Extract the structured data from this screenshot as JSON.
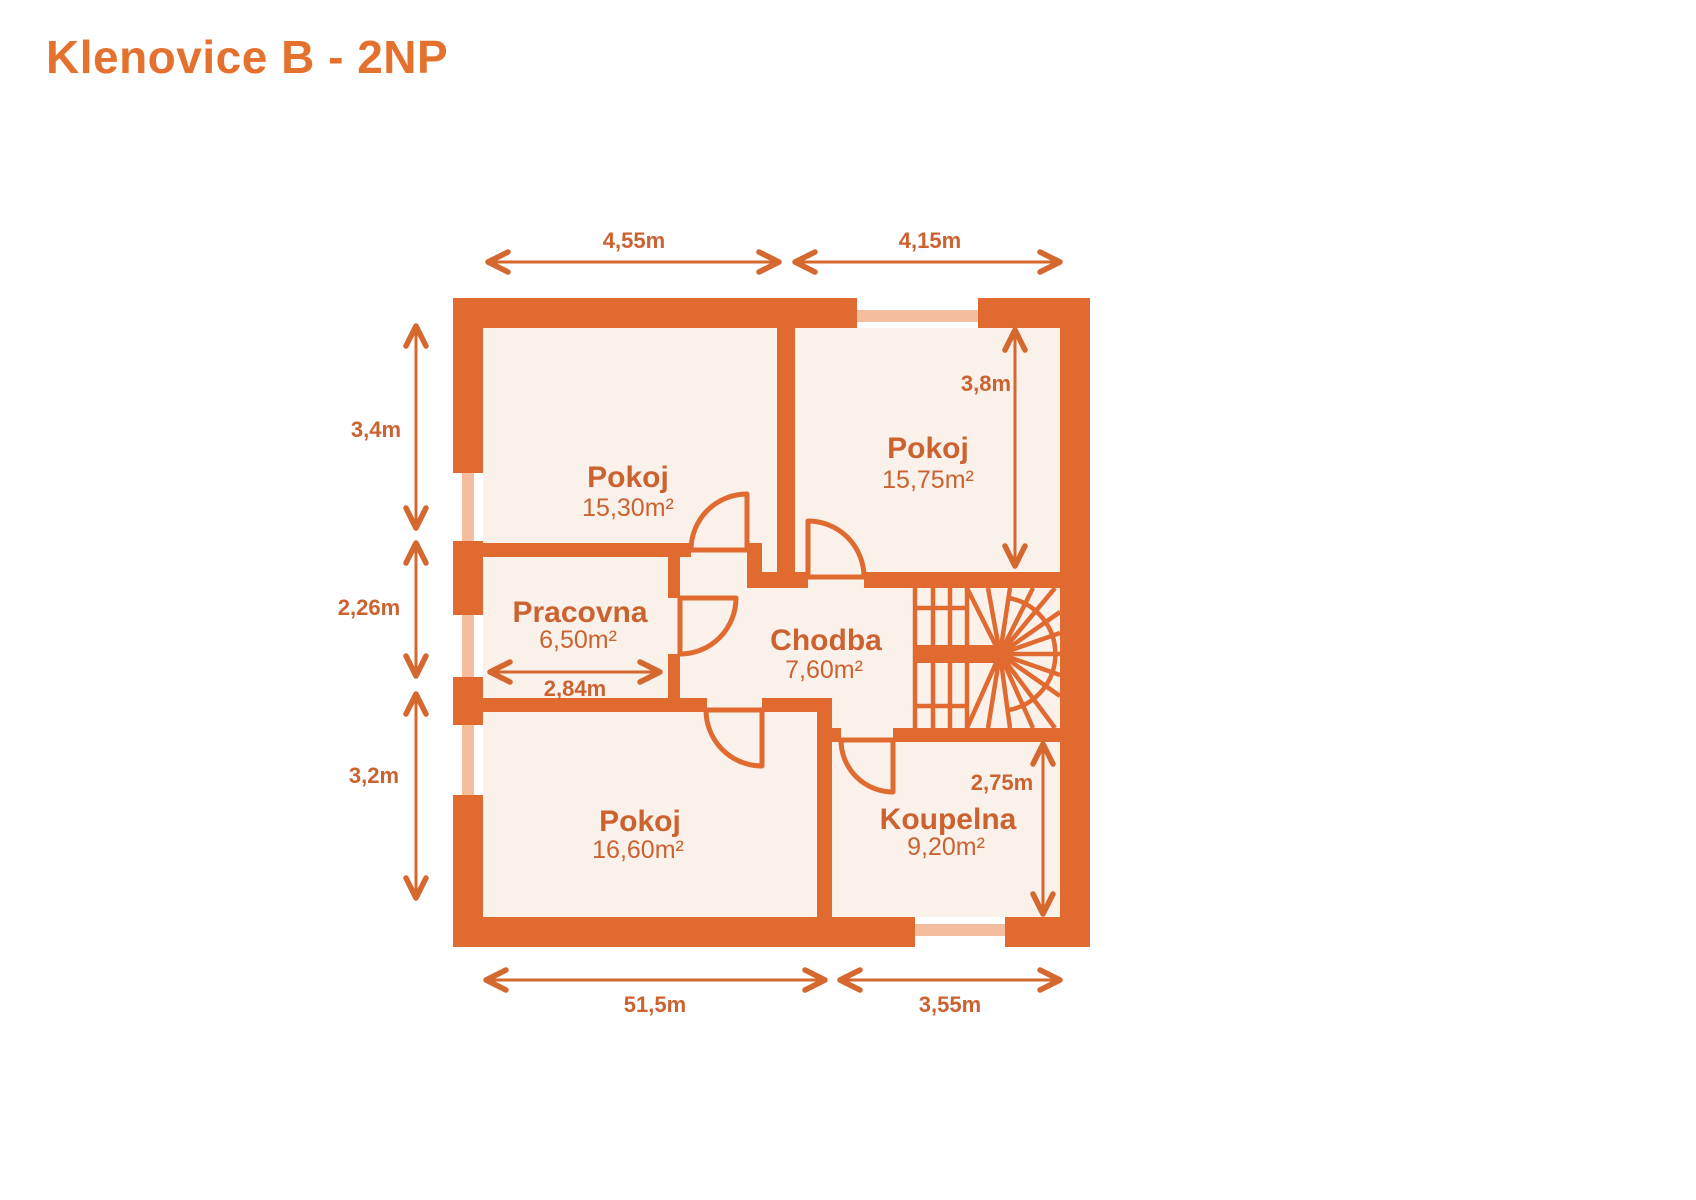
{
  "title": "Klenovice B - 2NP",
  "colors": {
    "wall": "#e06a30",
    "window": "#f4bd9e",
    "room": "#faf1eb",
    "text": "#cb6230",
    "arrow": "#d4682e",
    "title": "#e5712f",
    "bg": "#ffffff"
  },
  "rooms": [
    {
      "name": "Pokoj",
      "area": "15,30m²"
    },
    {
      "name": "Pokoj",
      "area": "15,75m²"
    },
    {
      "name": "Pracovna",
      "area": "6,50m²"
    },
    {
      "name": "Chodba",
      "area": "7,60m²"
    },
    {
      "name": "Pokoj",
      "area": "16,60m²"
    },
    {
      "name": "Koupelna",
      "area": "9,20m²"
    }
  ],
  "dimensions": {
    "top_left": "4,55m",
    "top_right": "4,15m",
    "left_upper": "3,4m",
    "left_middle": "2,26m",
    "left_lower": "3,2m",
    "bottom_left": "51,5m",
    "bottom_right": "3,55m",
    "room_top_right_height": "3,8m",
    "bathroom_height": "2,75m",
    "study_width": "2,84m"
  }
}
